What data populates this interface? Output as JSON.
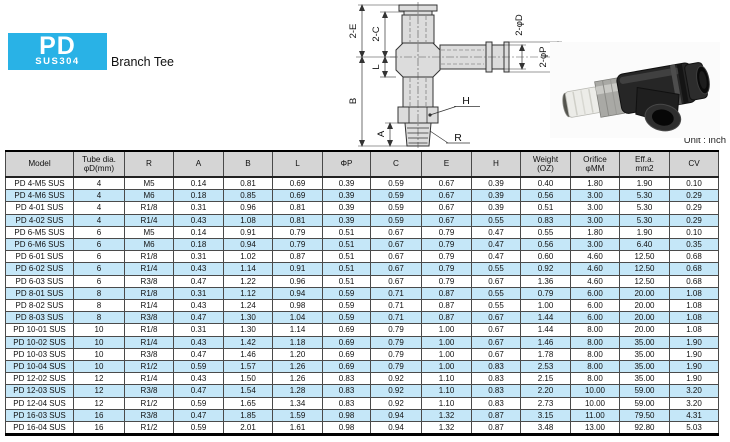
{
  "brand": {
    "name": "PD",
    "subtitle": "SUS304",
    "color": "#29b2e6"
  },
  "page": {
    "product_name": "Branch Tee",
    "unit_label": "Unit : inch"
  },
  "colors": {
    "row_stripe": "#c5e7f8",
    "header_bg": "#d5d5d5",
    "accent": "#29b2e6"
  },
  "diagram": {
    "labels": {
      "e": "2-E",
      "c": "2-C",
      "l": "L",
      "b": "B",
      "a": "A",
      "h": "H",
      "r": "R",
      "d": "2-φD",
      "p": "2-φP"
    }
  },
  "table": {
    "headers": [
      "Model",
      "Tube dia.\nφD(mm)",
      "R",
      "A",
      "B",
      "L",
      "ΦP",
      "C",
      "E",
      "H",
      "Weight\n(OZ)",
      "Orifice\nφMM",
      "Eff.a.\nmm2",
      "CV"
    ],
    "rows": [
      [
        "PD 4-M5 SUS",
        "4",
        "M5",
        "0.14",
        "0.81",
        "0.69",
        "0.39",
        "0.59",
        "0.67",
        "0.39",
        "0.40",
        "1.80",
        "1.90",
        "0.10"
      ],
      [
        "PD 4-M6 SUS",
        "4",
        "M6",
        "0.18",
        "0.85",
        "0.69",
        "0.39",
        "0.59",
        "0.67",
        "0.39",
        "0.56",
        "3.00",
        "5.30",
        "0.29"
      ],
      [
        "PD 4-01 SUS",
        "4",
        "R1/8",
        "0.31",
        "0.96",
        "0.81",
        "0.39",
        "0.59",
        "0.67",
        "0.39",
        "0.51",
        "3.00",
        "5.30",
        "0.29"
      ],
      [
        "PD 4-02 SUS",
        "4",
        "R1/4",
        "0.43",
        "1.08",
        "0.81",
        "0.39",
        "0.59",
        "0.67",
        "0.55",
        "0.83",
        "3.00",
        "5.30",
        "0.29"
      ],
      [
        "PD 6-M5 SUS",
        "6",
        "M5",
        "0.14",
        "0.91",
        "0.79",
        "0.51",
        "0.67",
        "0.79",
        "0.47",
        "0.55",
        "1.80",
        "1.90",
        "0.10"
      ],
      [
        "PD 6-M6 SUS",
        "6",
        "M6",
        "0.18",
        "0.94",
        "0.79",
        "0.51",
        "0.67",
        "0.79",
        "0.47",
        "0.56",
        "3.00",
        "6.40",
        "0.35"
      ],
      [
        "PD 6-01 SUS",
        "6",
        "R1/8",
        "0.31",
        "1.02",
        "0.87",
        "0.51",
        "0.67",
        "0.79",
        "0.47",
        "0.60",
        "4.60",
        "12.50",
        "0.68"
      ],
      [
        "PD 6-02 SUS",
        "6",
        "R1/4",
        "0.43",
        "1.14",
        "0.91",
        "0.51",
        "0.67",
        "0.79",
        "0.55",
        "0.92",
        "4.60",
        "12.50",
        "0.68"
      ],
      [
        "PD 6-03 SUS",
        "6",
        "R3/8",
        "0.47",
        "1.22",
        "0.96",
        "0.51",
        "0.67",
        "0.79",
        "0.67",
        "1.36",
        "4.60",
        "12.50",
        "0.68"
      ],
      [
        "PD 8-01 SUS",
        "8",
        "R1/8",
        "0.31",
        "1.12",
        "0.94",
        "0.59",
        "0.71",
        "0.87",
        "0.55",
        "0.79",
        "6.00",
        "20.00",
        "1.08"
      ],
      [
        "PD 8-02 SUS",
        "8",
        "R1/4",
        "0.43",
        "1.24",
        "0.98",
        "0.59",
        "0.71",
        "0.87",
        "0.55",
        "1.00",
        "6.00",
        "20.00",
        "1.08"
      ],
      [
        "PD 8-03 SUS",
        "8",
        "R3/8",
        "0.47",
        "1.30",
        "1.04",
        "0.59",
        "0.71",
        "0.87",
        "0.67",
        "1.44",
        "6.00",
        "20.00",
        "1.08"
      ],
      [
        "PD 10-01 SUS",
        "10",
        "R1/8",
        "0.31",
        "1.30",
        "1.14",
        "0.69",
        "0.79",
        "1.00",
        "0.67",
        "1.44",
        "8.00",
        "20.00",
        "1.08"
      ],
      [
        "PD 10-02 SUS",
        "10",
        "R1/4",
        "0.43",
        "1.42",
        "1.18",
        "0.69",
        "0.79",
        "1.00",
        "0.67",
        "1.46",
        "8.00",
        "35.00",
        "1.90"
      ],
      [
        "PD 10-03 SUS",
        "10",
        "R3/8",
        "0.47",
        "1.46",
        "1.20",
        "0.69",
        "0.79",
        "1.00",
        "0.67",
        "1.78",
        "8.00",
        "35.00",
        "1.90"
      ],
      [
        "PD 10-04 SUS",
        "10",
        "R1/2",
        "0.59",
        "1.57",
        "1.26",
        "0.69",
        "0.79",
        "1.00",
        "0.83",
        "2.53",
        "8.00",
        "35.00",
        "1.90"
      ],
      [
        "PD 12-02 SUS",
        "12",
        "R1/4",
        "0.43",
        "1.50",
        "1.26",
        "0.83",
        "0.92",
        "1.10",
        "0.83",
        "2.15",
        "8.00",
        "35.00",
        "1.90"
      ],
      [
        "PD 12-03 SUS",
        "12",
        "R3/8",
        "0.47",
        "1.54",
        "1.28",
        "0.83",
        "0.92",
        "1.10",
        "0.83",
        "2.20",
        "10.00",
        "59.00",
        "3.20"
      ],
      [
        "PD 12-04 SUS",
        "12",
        "R1/2",
        "0.59",
        "1.65",
        "1.34",
        "0.83",
        "0.92",
        "1.10",
        "0.83",
        "2.73",
        "10.00",
        "59.00",
        "3.20"
      ],
      [
        "PD 16-03 SUS",
        "16",
        "R3/8",
        "0.47",
        "1.85",
        "1.59",
        "0.98",
        "0.94",
        "1.32",
        "0.87",
        "3.15",
        "11.00",
        "79.50",
        "4.31"
      ],
      [
        "PD 16-04 SUS",
        "16",
        "R1/2",
        "0.59",
        "2.01",
        "1.61",
        "0.98",
        "0.94",
        "1.32",
        "0.87",
        "3.48",
        "13.00",
        "92.80",
        "5.03"
      ]
    ]
  }
}
